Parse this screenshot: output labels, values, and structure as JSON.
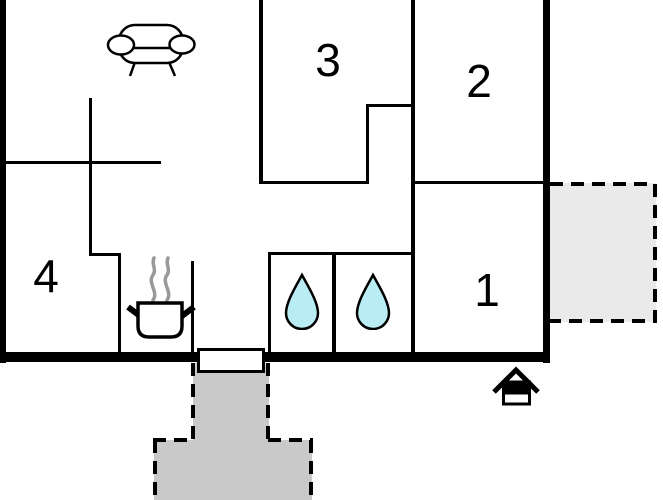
{
  "floorplan": {
    "rooms": [
      {
        "id": "room-3",
        "label": "3"
      },
      {
        "id": "room-2",
        "label": "2"
      },
      {
        "id": "room-1",
        "label": "1"
      },
      {
        "id": "room-4",
        "label": "4"
      }
    ],
    "icons": [
      {
        "name": "sofa-icon"
      },
      {
        "name": "cooking-pot-steam-icon"
      },
      {
        "name": "water-drop-icon",
        "count": 2
      },
      {
        "name": "house-entrance-icon"
      }
    ],
    "colors": {
      "wall": "#000000",
      "water_drop_fill": "#b9edf3",
      "terrace_right_fill": "#eaeaea",
      "terrace_bottom_fill": "#c9c9c9",
      "steam": "#999999",
      "background": "#ffffff"
    }
  }
}
